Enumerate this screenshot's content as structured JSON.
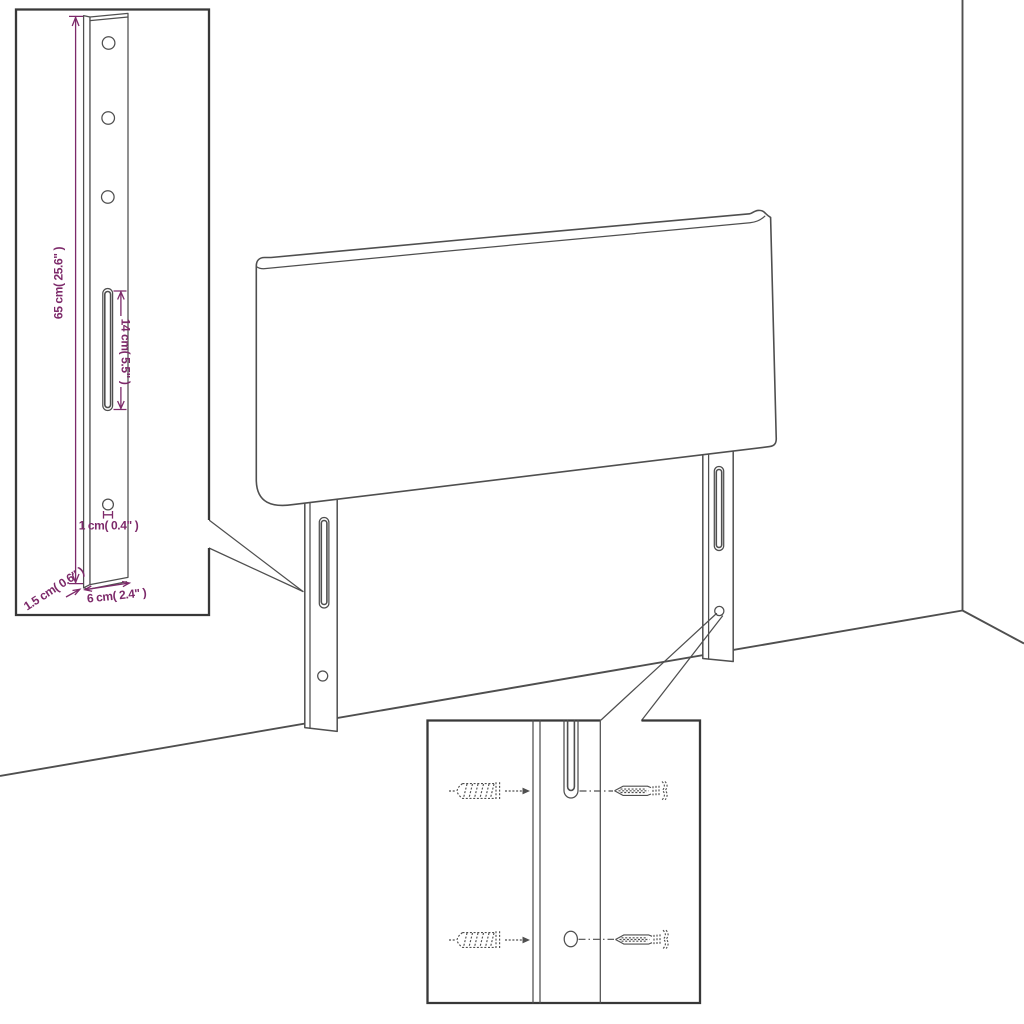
{
  "dimension_labels": {
    "leg_height": "65 cm( 25.6\" )",
    "slot_length": "14 cm( 5.5\" )",
    "hole": "1 cm( 0.4\" )",
    "thickness": "1.5 cm( 0.6\" )",
    "width": "6 cm( 2.4\" )"
  },
  "colors": {
    "line": "#4f4f4f",
    "border": "#383838",
    "dim": "#7d2a6a",
    "bg": "#ffffff"
  }
}
